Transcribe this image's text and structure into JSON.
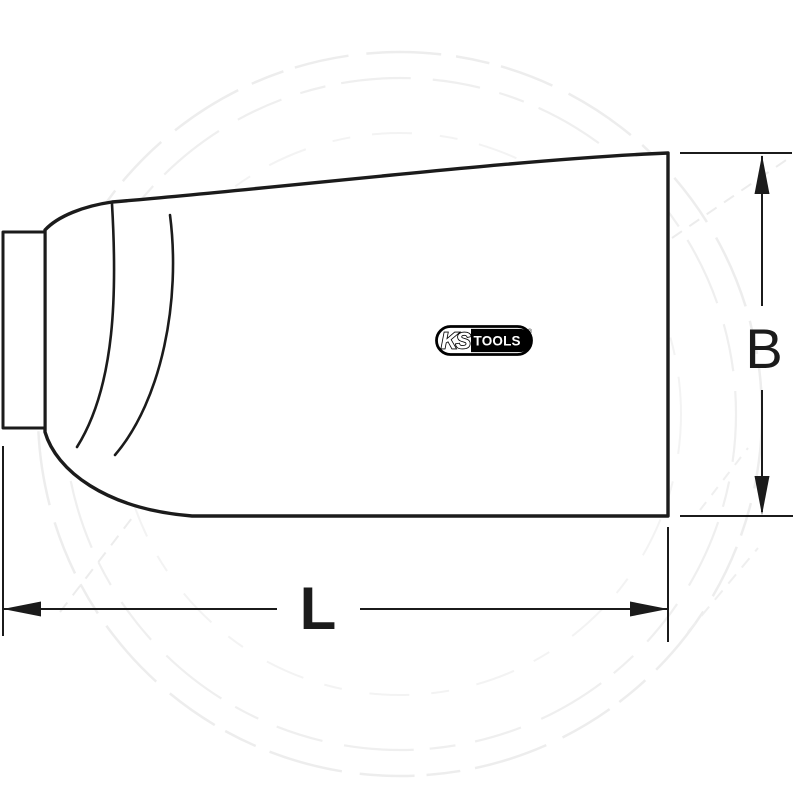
{
  "page": {
    "background": "#ffffff",
    "line_color": "#1b1b1b",
    "watermark_color": "#ededed"
  },
  "drawing": {
    "dimensions": {
      "length_label": "L",
      "width_label": "B"
    }
  },
  "logo": {
    "ks": "KS",
    "tools": "TOOLS",
    "registered": "®",
    "border_color": "#000000",
    "tools_block_color": "#000000",
    "tools_text_color": "#ffffff"
  }
}
